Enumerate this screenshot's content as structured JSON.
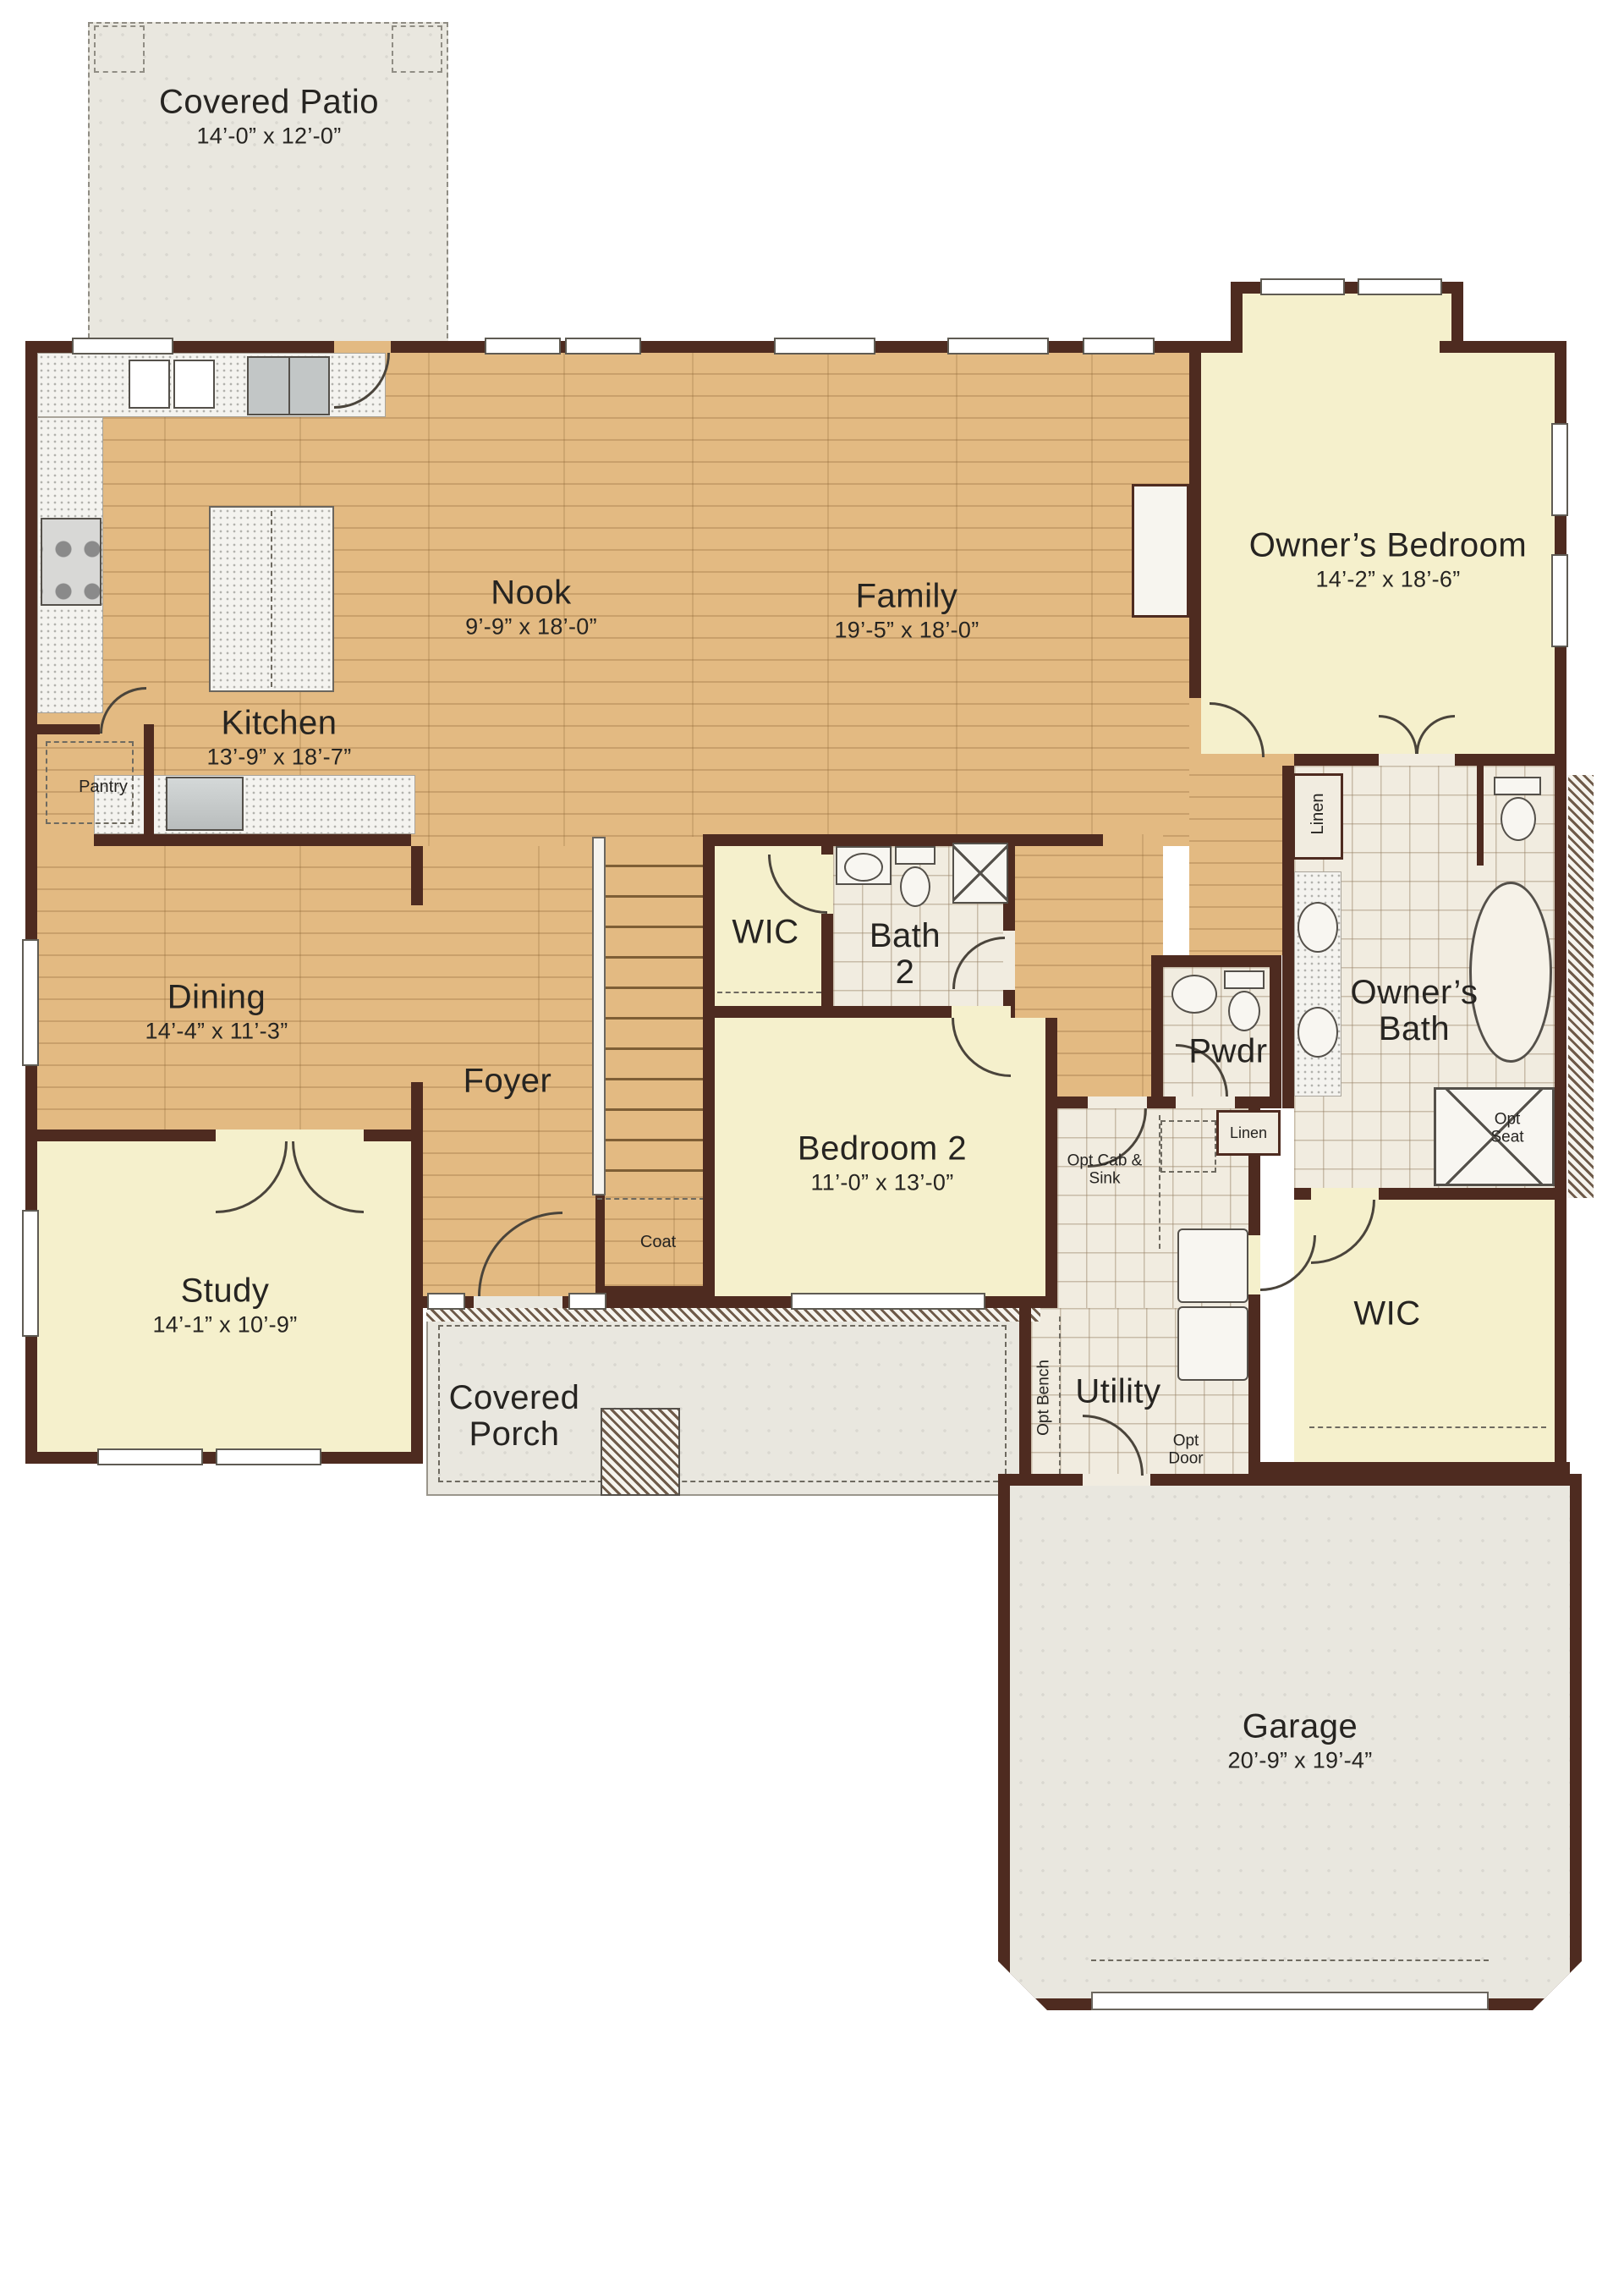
{
  "title": "First Floor Plan",
  "colors": {
    "wall": "#4e2b20",
    "wood": "#e3ba82",
    "cream": "#f5f0cc",
    "tile": "#f1ece0",
    "slab": "#e9e7df",
    "text": "#262421"
  },
  "rooms": [
    {
      "id": "covered-patio",
      "label": "Covered Patio",
      "dims": "14’-0” x 12’-0”"
    },
    {
      "id": "kitchen",
      "label": "Kitchen",
      "dims": "13’-9” x 18’-7”"
    },
    {
      "id": "nook",
      "label": "Nook",
      "dims": "9’-9” x 18’-0”"
    },
    {
      "id": "family",
      "label": "Family",
      "dims": "19’-5” x 18’-0”"
    },
    {
      "id": "owners-bedroom",
      "label": "Owner’s Bedroom",
      "dims": "14’-2” x 18’-6”"
    },
    {
      "id": "dining",
      "label": "Dining",
      "dims": "14’-4” x 11’-3”"
    },
    {
      "id": "foyer",
      "label": "Foyer",
      "dims": ""
    },
    {
      "id": "wic",
      "label": "WIC",
      "dims": ""
    },
    {
      "id": "bath-2",
      "label": "Bath 2",
      "dims": ""
    },
    {
      "id": "bedroom-2",
      "label": "Bedroom 2",
      "dims": "11’-0” x 13’-0”"
    },
    {
      "id": "pwdr",
      "label": "Pwdr",
      "dims": ""
    },
    {
      "id": "owners-bath",
      "label": "Owner’s Bath",
      "dims": ""
    },
    {
      "id": "study",
      "label": "Study",
      "dims": "14’-1” x 10’-9”"
    },
    {
      "id": "covered-porch",
      "label": "Covered Porch",
      "dims": ""
    },
    {
      "id": "utility",
      "label": "Utility",
      "dims": ""
    },
    {
      "id": "wic-2",
      "label": "WIC",
      "dims": ""
    },
    {
      "id": "garage",
      "label": "Garage",
      "dims": "20’-9” x 19’-4”"
    }
  ],
  "annotations": [
    {
      "id": "pantry",
      "label": "Pantry"
    },
    {
      "id": "coat",
      "label": "Coat"
    },
    {
      "id": "linen-1",
      "label": "Linen"
    },
    {
      "id": "linen-2",
      "label": "Linen"
    },
    {
      "id": "opt-seat",
      "label": "Opt Seat"
    },
    {
      "id": "opt-cab-sink",
      "label": "Opt Cab & Sink"
    },
    {
      "id": "opt-bench",
      "label": "Opt Bench"
    },
    {
      "id": "opt-door",
      "label": "Opt Door"
    }
  ]
}
